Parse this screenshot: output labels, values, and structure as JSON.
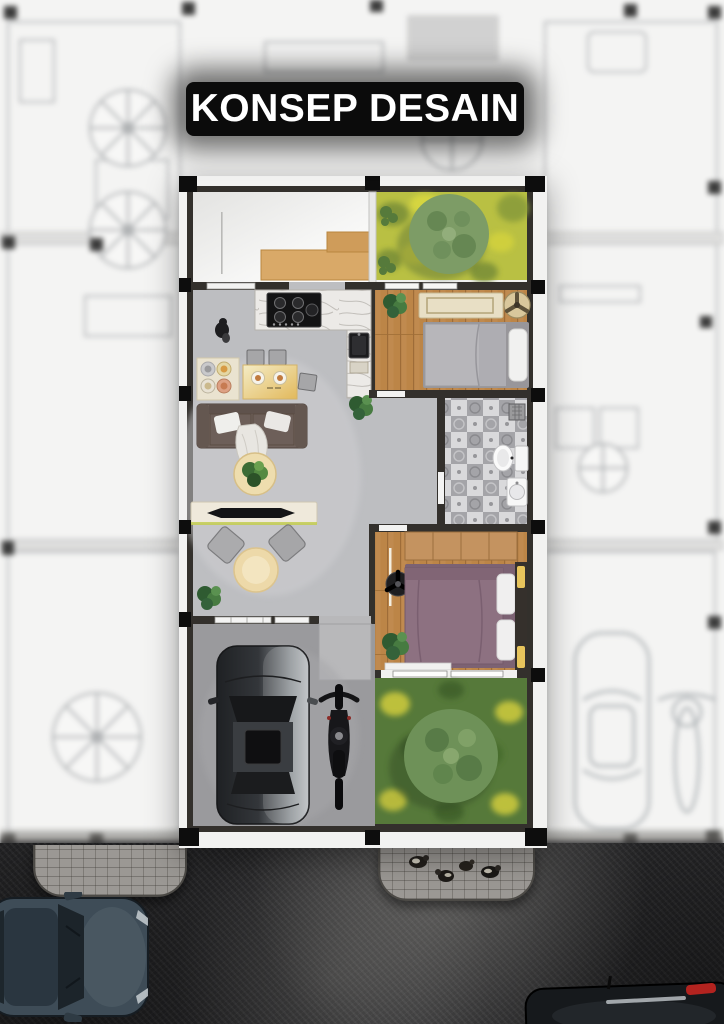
{
  "title": {
    "text": "KONSEP DESAIN"
  },
  "scene": {
    "type": "floor-plan-render-poster",
    "rooms": [
      {
        "name": "service-area",
        "floor": "white-ceramic",
        "features": [
          "wood-counter"
        ]
      },
      {
        "name": "front-garden",
        "floor": "grass",
        "features": [
          "round-tree",
          "shrubs"
        ]
      },
      {
        "name": "kitchen",
        "floor": "concrete",
        "features": [
          "marble-counter",
          "gas-stove",
          "sink",
          "cutting-board"
        ]
      },
      {
        "name": "living-dining",
        "floor": "concrete",
        "features": [
          "dining-table",
          "dining-chairs",
          "floor-mat-with-plates",
          "sofa",
          "throw-pillows",
          "coffee-table-with-plant",
          "tv-console",
          "lounge-chairs",
          "round-side-table",
          "potted-plants"
        ]
      },
      {
        "name": "bedroom-1",
        "floor": "wood-plank",
        "features": [
          "single-bed",
          "low-cabinet",
          "ceiling-fan",
          "plant"
        ]
      },
      {
        "name": "bathroom",
        "floor": "patterned-tile",
        "features": [
          "toilet",
          "wash-basin",
          "shower-drain",
          "door"
        ]
      },
      {
        "name": "hallway",
        "floor": "concrete",
        "features": [
          "plant"
        ]
      },
      {
        "name": "bedroom-2",
        "floor": "wood-plank",
        "features": [
          "double-bed",
          "wardrobe",
          "ceiling-fan",
          "headboard-lights",
          "plant",
          "door-mat"
        ]
      },
      {
        "name": "rear-garden",
        "floor": "grass",
        "features": [
          "round-tree"
        ]
      },
      {
        "name": "carport",
        "floor": "concrete-paving",
        "features": [
          "car-top-view",
          "motorcycle-top-view",
          "entry-pad"
        ]
      }
    ],
    "street": {
      "surface": "asphalt",
      "features": [
        "paver-apron-left",
        "paver-apron-right",
        "chickens-on-apron",
        "car-driving-top-view",
        "parked-car-partial-top-view"
      ]
    },
    "background": "blurred-cad-line-floor-plan-with-trees-car-motorcycle-columns"
  },
  "palette": {
    "title_bg": "#0b0b0b",
    "title_text": "#ffffff",
    "asphalt": "#2b2b2d",
    "paver": "#9b9894",
    "outer_wall": "#f2f2f1",
    "inner_wall": "#33302c",
    "concrete_floor": "#bdbec1",
    "carport_floor": "#9a9a9d",
    "wood_floor": "#c08a4f",
    "marble_counter": "#eceae7",
    "grass_front": "#b9c043",
    "grass_rear": "#56793a",
    "tree_canopy": "#7d9c66",
    "sofa": "#70625c",
    "duvet_bedroom1": "#b7b6ba",
    "duvet_bedroom2": "#8d7181",
    "car_body": "#33363a",
    "street_car_body": "#3e4c57",
    "taillight_red": "#b3231f"
  }
}
